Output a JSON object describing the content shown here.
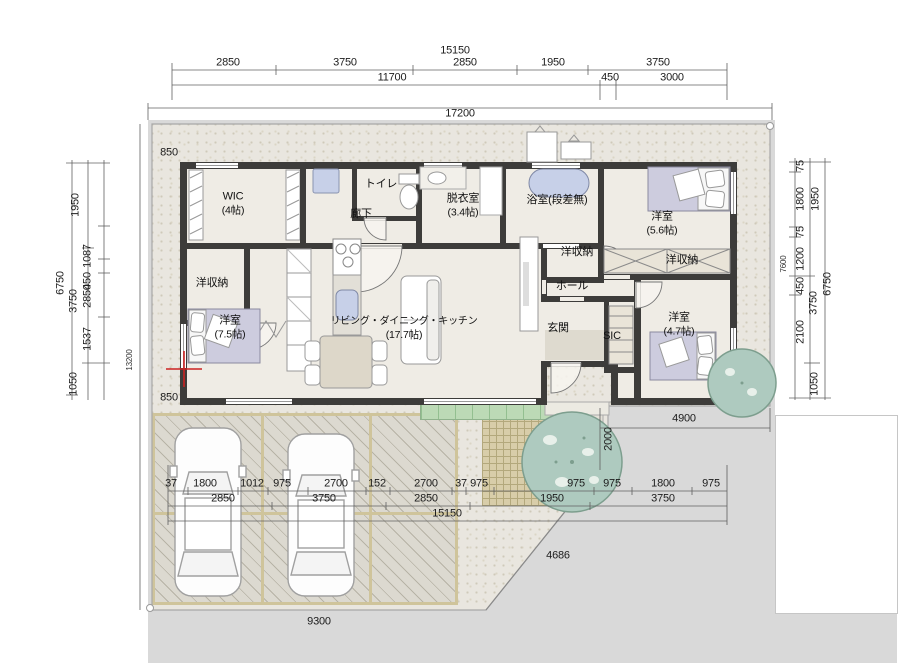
{
  "plan": {
    "type": "floor-plan",
    "colors": {
      "wall": "#3d3c3a",
      "floor": "#efece5",
      "site_ground": "#e9e6df",
      "outside_gray": "#d9d9d9",
      "bed": "#cdccde",
      "water_fixture": "#c7d0e8",
      "deck_green": "#bcdab6",
      "tree_green": "#aecabf",
      "paving_tan": "#cfc49b",
      "grid_cross_red": "#cc2222"
    }
  },
  "rooms": [
    {
      "label": "WIC",
      "size": "(4帖)"
    },
    {
      "label": "洋収納"
    },
    {
      "label": "洋室",
      "size": "(7.5帖)"
    },
    {
      "label": "廊下"
    },
    {
      "label": "トイレ"
    },
    {
      "label": "脱衣室",
      "size": "(3.4帖)"
    },
    {
      "label": "浴室(段差無)"
    },
    {
      "label": "洋室",
      "size": "(5.6帖)"
    },
    {
      "label": "洋収納"
    },
    {
      "label": "洋収納"
    },
    {
      "label": "ホール"
    },
    {
      "label": "玄関"
    },
    {
      "label": "SIC"
    },
    {
      "label": "洋室",
      "size": "(4.7帖)"
    },
    {
      "label": "リビング・ダイニング・キッチン",
      "size": "(17.7帖)"
    }
  ],
  "dims": {
    "top": [
      "15150",
      "2850",
      "3750",
      "2850",
      "1950",
      "3750",
      "11700",
      "450",
      "3000",
      "17200"
    ],
    "left": [
      "1950",
      "1087",
      "450",
      "2850",
      "3750",
      "1537",
      "1050",
      "6750",
      "13200",
      "850",
      "850"
    ],
    "right": [
      "75",
      "1800",
      "75",
      "1200",
      "450",
      "2100",
      "1050",
      "1950",
      "3750",
      "6750",
      "7600"
    ],
    "bottom": [
      "37",
      "1800",
      "1012",
      "975",
      "2700",
      "152",
      "2700",
      "37",
      "975",
      "975",
      "975",
      "1800",
      "975",
      "2850",
      "3750",
      "2850",
      "1950",
      "3750",
      "15150"
    ],
    "site": [
      "4900",
      "2000",
      "4686",
      "9300"
    ]
  }
}
